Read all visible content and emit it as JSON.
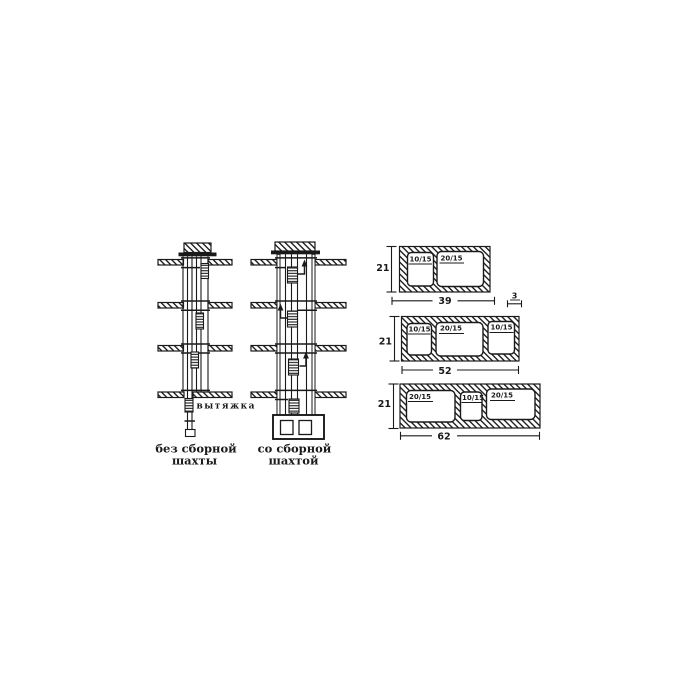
{
  "background": "#ffffff",
  "ink": "#1a1a1a",
  "left_panel": {
    "exhaust_label": "вытяжка",
    "shaft_without": {
      "caption_line1": "без сборной",
      "caption_line2": "шахты"
    },
    "shaft_with": {
      "caption_line1": "со сборной",
      "caption_line2": "шахтой"
    }
  },
  "blocks_panel": {
    "wall_thickness": {
      "label": "3"
    },
    "blocks": [
      {
        "height": "21",
        "width": "39",
        "openings": [
          "10/15",
          "20/15"
        ]
      },
      {
        "height": "21",
        "width": "52",
        "openings": [
          "10/15",
          "20/15",
          "10/15"
        ]
      },
      {
        "height": "21",
        "width": "62",
        "openings": [
          "20/15",
          "10/15",
          "20/15"
        ]
      }
    ]
  }
}
